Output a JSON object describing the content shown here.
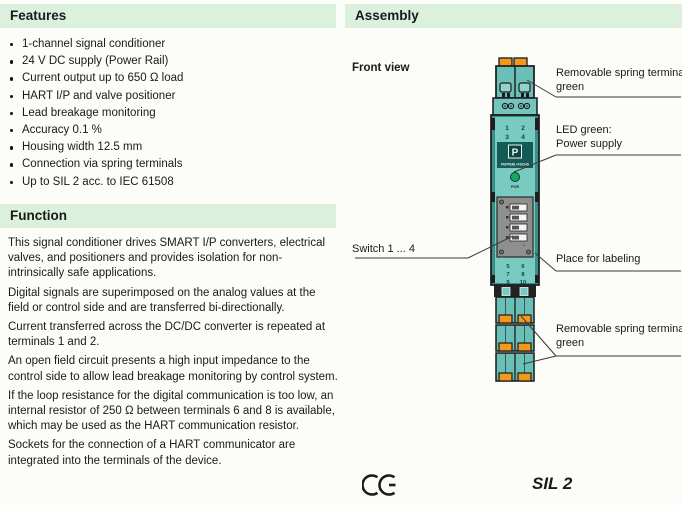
{
  "colors": {
    "section_band": "#dcf1dd",
    "device_teal": "#6abfb7",
    "device_teal_dark": "#2e7d76",
    "terminal_orange": "#f2991d",
    "led_green": "#16a663",
    "panel_gray": "#8f8f8f"
  },
  "features": {
    "title": "Features",
    "items": [
      "1-channel signal conditioner",
      "24 V DC supply (Power Rail)",
      "Current output up to 650 Ω load",
      "HART I/P and valve positioner",
      "Lead breakage monitoring",
      "Accuracy 0.1 %",
      "Housing width 12.5 mm",
      "Connection via spring terminals",
      "Up to SIL 2 acc. to IEC 61508"
    ]
  },
  "function": {
    "title": "Function",
    "paragraphs": [
      "This signal conditioner drives SMART I/P converters, electrical valves, and positioners and provides isolation for non-intrinsically safe applications.",
      "Digital signals are superimposed on the analog values at the field or control side and are transferred bi-directionally.",
      "Current transferred across the DC/DC converter is repeated at terminals 1 and 2.",
      "An open field circuit presents a high input impedance to the control side to allow lead breakage monitoring by control system.",
      "If the loop resistance for the digital communication is too low, an internal resistor of 250 Ω between terminals 6 and 8 is available, which may be used as the HART communication resistor.",
      "Sockets for the connection of a HART communicator are integrated into the terminals of the device."
    ]
  },
  "assembly": {
    "title": "Assembly",
    "front_view_label": "Front view",
    "callouts": {
      "top_terminal": "Removable spring terminal green",
      "led": "LED green:\nPower supply",
      "switches": "Switch 1 ... 4",
      "labeling": "Place for labeling",
      "bottom_terminals": "Removable spring terminals green"
    },
    "device": {
      "brand": "PEPPERL+FUCHS",
      "led_label": "PWR",
      "switch_row_label": "1",
      "terminals_top": [
        "1",
        "2",
        "3",
        "4"
      ],
      "terminals_bottom": [
        "5",
        "6",
        "7",
        "8",
        "9",
        "10"
      ]
    },
    "ce_mark": "CE",
    "sil_rating": "SIL 2"
  }
}
